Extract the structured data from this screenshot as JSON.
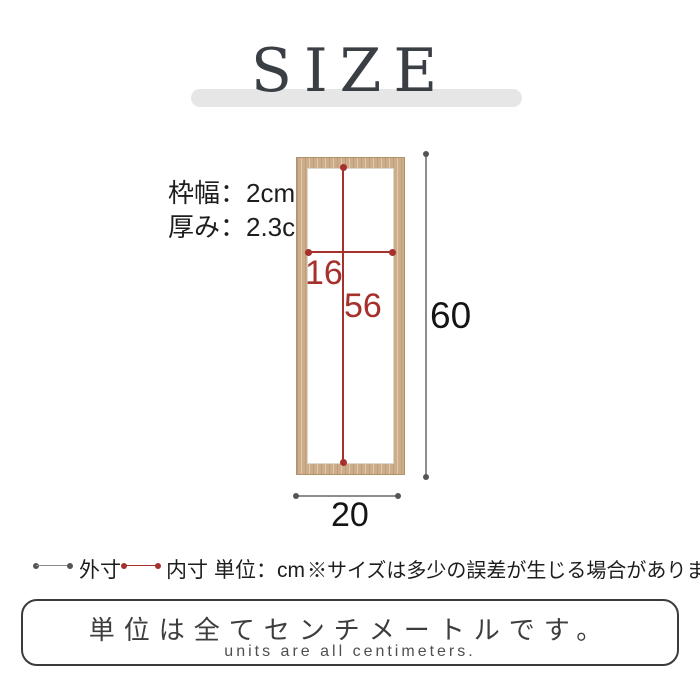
{
  "title": "SIZE",
  "product_diagram": {
    "frame_width_label": "枠幅：2cm",
    "thickness_label": "厚み：2.3cm",
    "inner_width_cm": "16",
    "inner_height_cm": "56",
    "outer_height_cm": "60",
    "outer_width_cm": "20"
  },
  "legend": {
    "outer_label": "外寸",
    "inner_label": "内寸",
    "unit_label": "単位：cm",
    "tolerance_note": "※サイズは多少の誤差が生じる場合があります。"
  },
  "footer": {
    "jp": "単位は全てセンチメートルです。",
    "en": "units are all centimeters."
  },
  "colors": {
    "inner-dim": "#a5302c",
    "outer-dim": "#8d8d8d",
    "outer-dot": "#555555",
    "wood": "#cdad89",
    "wood-edge": "#b2916c",
    "title-bar": "#e6e6e6",
    "title-text": "#3a3f45",
    "text": "#1d1d1d"
  }
}
